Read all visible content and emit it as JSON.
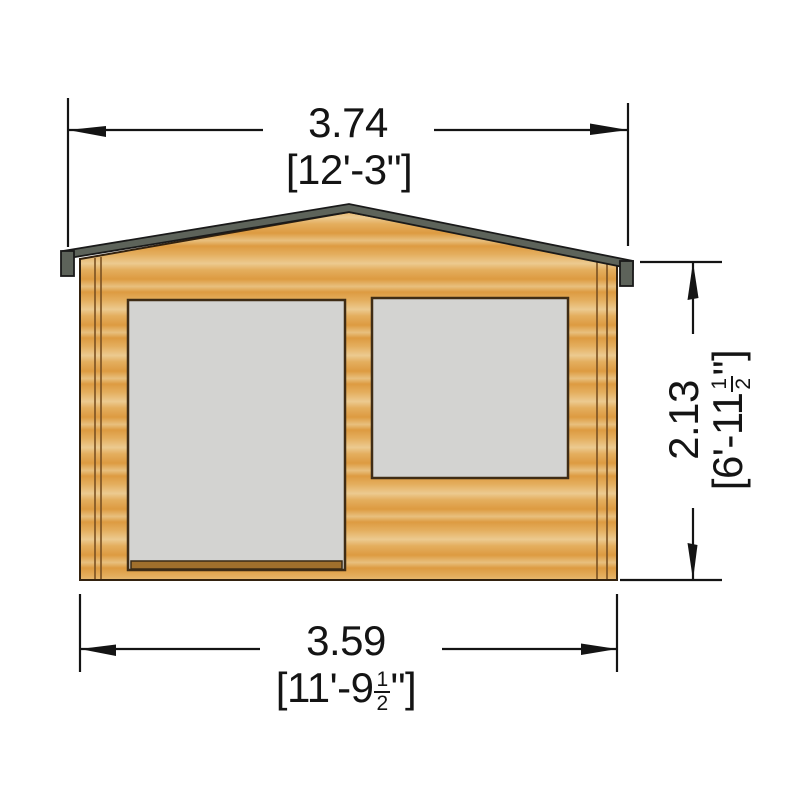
{
  "page": {
    "description": "Front elevation dimension drawing of a timber log cabin with glazed double door and window",
    "background": "#ffffff"
  },
  "colors": {
    "wood_dark": "#dd9b41",
    "wood_mid": "#e4ae5e",
    "wood_light": "#ecca90",
    "wood_midlight": "#e8c07e",
    "roof_gray": "#5d635a",
    "glass_gray": "#d3d3d1",
    "frame_brown": "#3f2c15",
    "trim_brown": "#7a5021",
    "sill_brown": "#a06f2c",
    "ink": "#141414"
  },
  "dimensions": {
    "roof_width": {
      "metric": "3.74",
      "imperial": "[12'-3\"]"
    },
    "wall_width": {
      "metric": "3.59",
      "imperial_prefix": "[11'-9",
      "fraction_numerator": "1",
      "fraction_denominator": "2",
      "imperial_suffix": "\"]"
    },
    "wall_height": {
      "metric": "2.13",
      "imperial_prefix": "[6'-11",
      "fraction_numerator": "1",
      "fraction_denominator": "2",
      "imperial_suffix": "\"]"
    }
  }
}
